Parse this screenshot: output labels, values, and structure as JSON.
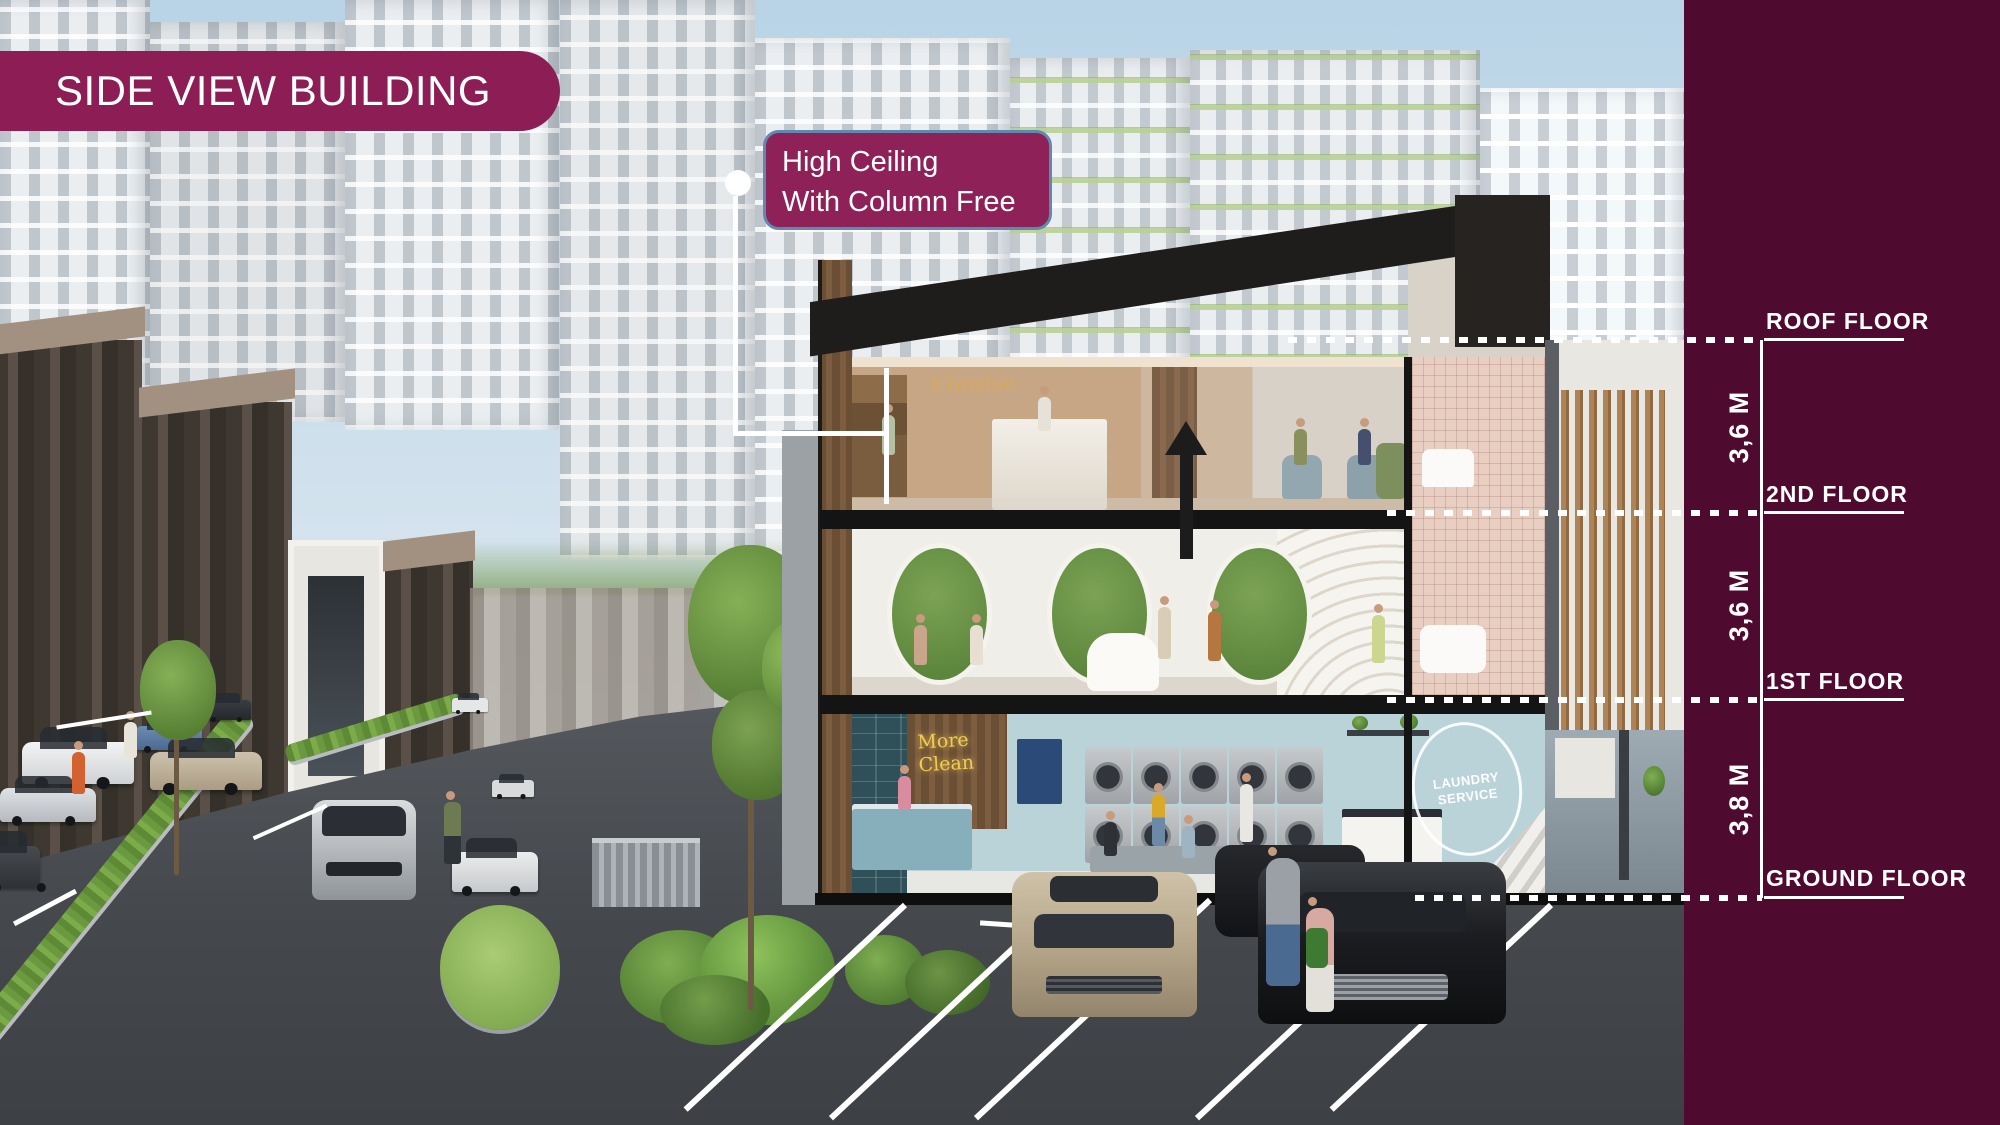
{
  "slide": {
    "title": "SIDE VIEW BUILDING",
    "callout": {
      "line1": "High Ceiling",
      "line2": "With Column Free"
    }
  },
  "elevation": {
    "levels": [
      {
        "label": "ROOF FLOOR"
      },
      {
        "label": "2ND FLOOR"
      },
      {
        "label": "1ST FLOOR"
      },
      {
        "label": "GROUND FLOOR"
      }
    ],
    "heights": [
      {
        "value": "3,6 M"
      },
      {
        "value": "3,6 M"
      },
      {
        "value": "3,8 M"
      }
    ]
  },
  "scene": {
    "salon_sign": "Elouise",
    "laundry_neon": {
      "line1": "More",
      "line2": "Clean"
    },
    "laundry_mural": "LAUNDRY SERVICE"
  },
  "colors": {
    "badge": "#8C1D55",
    "callout_fill": "#8E2158",
    "callout_border": "#6189AE",
    "panel": "#4F0A2F",
    "annotation": "#FFFFFF"
  }
}
